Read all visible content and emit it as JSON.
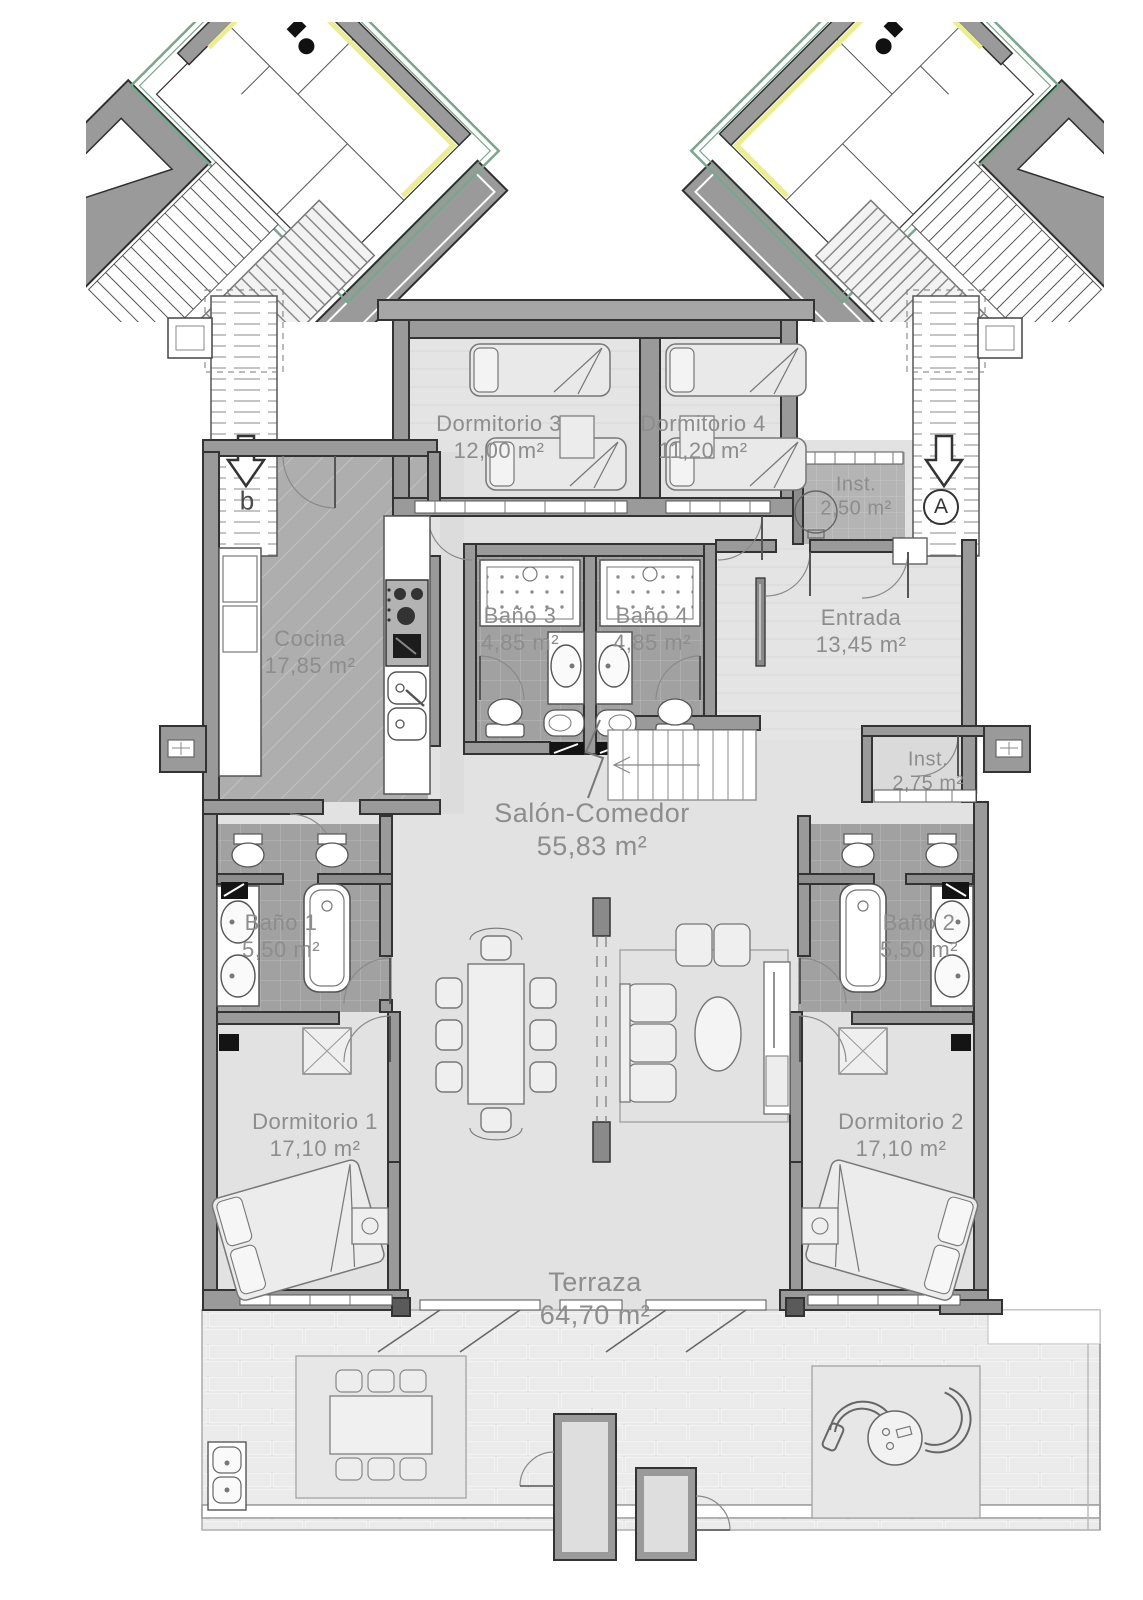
{
  "plan": {
    "type": "apartment-floor-plan",
    "stairs": {
      "left_letter": "b",
      "right_letter": "A"
    },
    "colors": {
      "wall": "#9a9a9a",
      "wall_outline": "#333333",
      "floor_light": "#e3e3e3",
      "floor_kitchen": "#aeaeae",
      "floor_tile": "#a1a1a1",
      "terrace_brick": "#ebebeb",
      "label_text": "#8d8d8d",
      "accent_green": "#7aa68e",
      "accent_yellow": "#ecec92"
    }
  },
  "rooms": {
    "dormitorio3": {
      "name": "Dormitorio 3",
      "area": "12,00 m²"
    },
    "dormitorio4": {
      "name": "Dormitorio 4",
      "area": "11,20 m²"
    },
    "inst_top": {
      "name": "Inst.",
      "area": "2,50 m²"
    },
    "cocina": {
      "name": "Cocina",
      "area": "17,85 m²"
    },
    "bano3": {
      "name": "Baño 3",
      "area": "4,85 m²"
    },
    "bano4": {
      "name": "Baño 4",
      "area": "4,85 m²"
    },
    "entrada": {
      "name": "Entrada",
      "area": "13,45 m²"
    },
    "inst_mid": {
      "name": "Inst.",
      "area": "2,75 m²"
    },
    "salon": {
      "name": "Salón-Comedor",
      "area": "55,83 m²"
    },
    "bano1": {
      "name": "Baño 1",
      "area": "5,50 m²"
    },
    "bano2": {
      "name": "Baño 2",
      "area": "5,50 m²"
    },
    "dormitorio1": {
      "name": "Dormitorio 1",
      "area": "17,10 m²"
    },
    "dormitorio2": {
      "name": "Dormitorio 2",
      "area": "17,10 m²"
    },
    "terraza": {
      "name": "Terraza",
      "area": "64,70 m²"
    }
  }
}
